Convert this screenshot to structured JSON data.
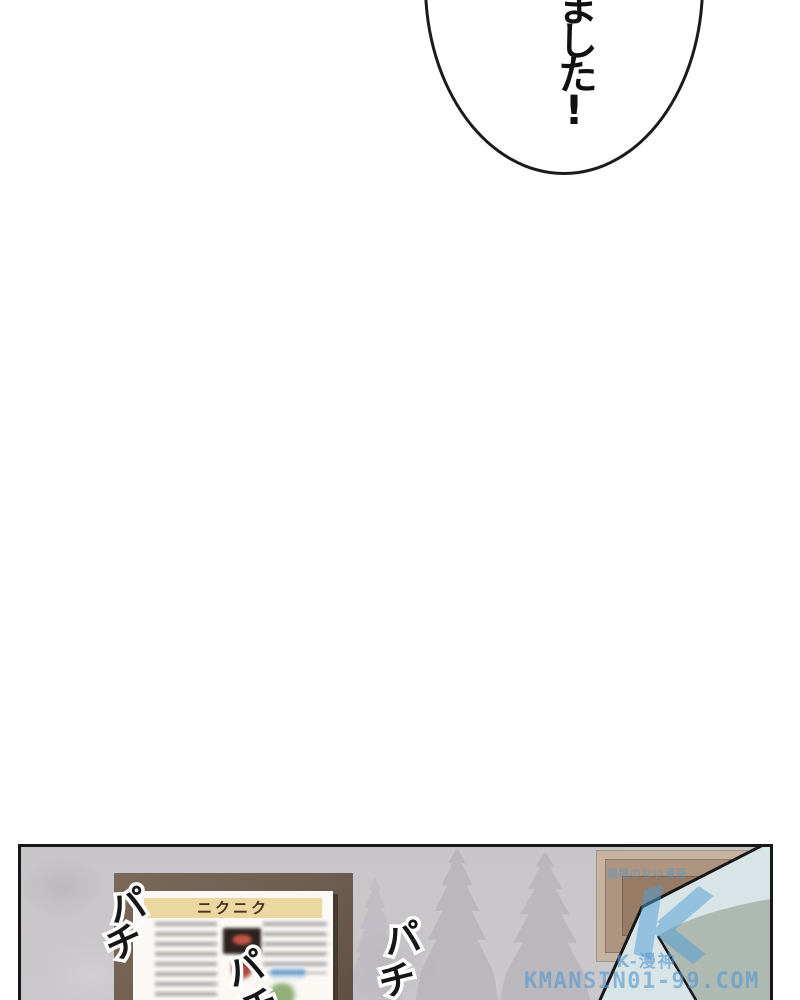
{
  "speech_bubble": {
    "text": "ました!"
  },
  "panel": {
    "menu_board": {
      "title": "ニクニク"
    },
    "sfx": {
      "left": {
        "pa": "パ",
        "chi": "チ"
      },
      "center": {
        "pa": "パ",
        "chi": "チ"
      },
      "right": {
        "pa": "パ",
        "chi": "チ"
      }
    },
    "watermark": {
      "slogan": "国境のない漫画",
      "site_name": "K-漫神",
      "site_url": "KMANSIN01-99.COM"
    }
  },
  "colors": {
    "watermark_blue": "#55a8d8",
    "wall_gray": "#c9c6ca",
    "menu_frame_brown": "#6f5e50",
    "banner_cream": "#ebd7a0",
    "hair_light": "#d9e4e6",
    "hair_shadow": "#aeb9b2"
  }
}
